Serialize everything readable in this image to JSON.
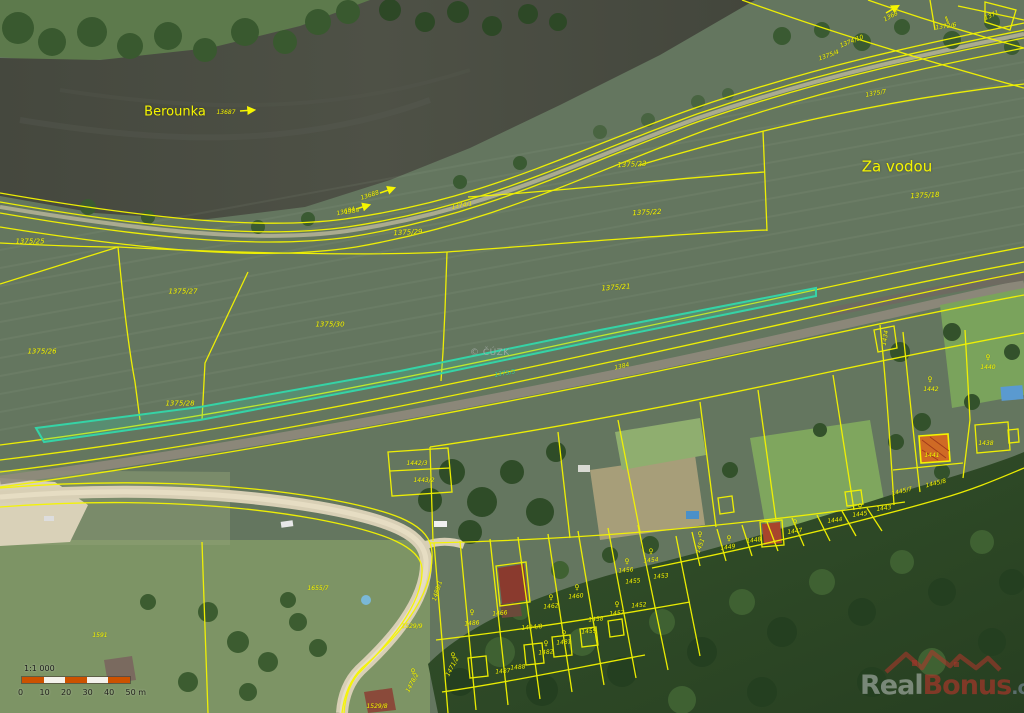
{
  "map": {
    "copyright": "© ČÚZK",
    "brand": {
      "real": "Real",
      "bonus": "Bonus",
      "cz": ".cz"
    },
    "scale_bar": {
      "ratio": "1:1 000",
      "ticks": [
        "0",
        "10",
        "20",
        "30",
        "40",
        "50 m"
      ]
    },
    "colors": {
      "parcel_line": "#f5f500",
      "parcel_label": "#f5f500",
      "highlight_parcel": "#35d3a6",
      "selected_building_fill": "#cf6a25",
      "scale_orange": "#cc5200",
      "river_water": "#46493f"
    },
    "highlighted_parcel": "1375/3",
    "selected_building": "1441",
    "labels": [
      {
        "t": "Berounka",
        "x": 175,
        "y": 112,
        "s": 13,
        "n": "river-name-label",
        "c": "place"
      },
      {
        "t": "Za vodou",
        "x": 897,
        "y": 167,
        "s": 15,
        "n": "place-name-label",
        "c": "place"
      },
      {
        "t": "13687",
        "x": 226,
        "y": 113,
        "s": 6,
        "n": "water-parcel-label"
      },
      {
        "t": "13688",
        "x": 370,
        "y": 196,
        "r": -18,
        "s": 6,
        "n": "water-parcel-label"
      },
      {
        "t": "13684",
        "x": 346,
        "y": 212,
        "r": -15,
        "s": 6,
        "n": "water-parcel-label"
      },
      {
        "t": "1368",
        "x": 891,
        "y": 17,
        "r": -28,
        "s": 6,
        "n": "water-parcel-label"
      },
      {
        "t": "1374/1",
        "x": 462,
        "y": 206,
        "r": -10,
        "s": 6
      },
      {
        "t": "1374/10",
        "x": 852,
        "y": 42,
        "r": -22,
        "s": 6
      },
      {
        "t": "1375/4",
        "x": 829,
        "y": 56,
        "r": -20,
        "s": 6
      },
      {
        "t": "1372/6",
        "x": 946,
        "y": 27,
        "r": -8,
        "s": 6
      },
      {
        "t": "1371",
        "x": 992,
        "y": 16,
        "r": -25,
        "s": 6
      },
      {
        "t": "1375/7",
        "x": 876,
        "y": 94,
        "r": -10,
        "s": 6
      },
      {
        "t": "1375/18",
        "x": 925,
        "y": 196,
        "r": -3
      },
      {
        "t": "1375/23",
        "x": 632,
        "y": 165,
        "r": -3
      },
      {
        "t": "1375/22",
        "x": 647,
        "y": 213,
        "r": -3
      },
      {
        "t": "1375/21",
        "x": 616,
        "y": 288,
        "r": -4
      },
      {
        "t": "1375/29",
        "x": 408,
        "y": 233,
        "r": -3
      },
      {
        "t": "1375/30",
        "x": 330,
        "y": 325
      },
      {
        "t": "1375/25",
        "x": 30,
        "y": 242
      },
      {
        "t": "1375/27",
        "x": 183,
        "y": 292
      },
      {
        "t": "1375/26",
        "x": 42,
        "y": 352
      },
      {
        "t": "1375/28",
        "x": 180,
        "y": 404
      },
      {
        "t": "1384",
        "x": 352,
        "y": 212,
        "r": -8,
        "s": 6
      },
      {
        "t": "1384",
        "x": 622,
        "y": 367,
        "r": -12,
        "s": 6
      },
      {
        "t": "1375/3",
        "x": 505,
        "y": 374,
        "r": -10,
        "s": 6,
        "c": "teal",
        "n": "highlighted-parcel-label"
      },
      {
        "t": "1442/3",
        "x": 417,
        "y": 464,
        "s": 6
      },
      {
        "t": "1443/2",
        "x": 424,
        "y": 481,
        "s": 6
      },
      {
        "t": "1434",
        "x": 886,
        "y": 338,
        "r": -80,
        "s": 6
      },
      {
        "t": "1440",
        "x": 988,
        "y": 368,
        "s": 6
      },
      {
        "t": "1442",
        "x": 931,
        "y": 390,
        "s": 6
      },
      {
        "t": "1441",
        "x": 932,
        "y": 456,
        "s": 6,
        "n": "selected-building-label"
      },
      {
        "t": "1438",
        "x": 986,
        "y": 444,
        "s": 6
      },
      {
        "t": "1445/8",
        "x": 936,
        "y": 484,
        "r": -14,
        "s": 6
      },
      {
        "t": "1445/7",
        "x": 902,
        "y": 492,
        "r": -14,
        "s": 6
      },
      {
        "t": "1443",
        "x": 884,
        "y": 509,
        "r": -8,
        "s": 6
      },
      {
        "t": "1445",
        "x": 860,
        "y": 515,
        "r": -8,
        "s": 6
      },
      {
        "t": "1444",
        "x": 835,
        "y": 521,
        "r": -8,
        "s": 6
      },
      {
        "t": "1447",
        "x": 795,
        "y": 532,
        "r": -8,
        "s": 6
      },
      {
        "t": "1448",
        "x": 754,
        "y": 541,
        "r": -8,
        "s": 6
      },
      {
        "t": "1449",
        "x": 728,
        "y": 548,
        "r": -8,
        "s": 6
      },
      {
        "t": "1451",
        "x": 701,
        "y": 546,
        "r": -70,
        "s": 6
      },
      {
        "t": "1456",
        "x": 626,
        "y": 571,
        "r": -5,
        "s": 6
      },
      {
        "t": "1455",
        "x": 633,
        "y": 582,
        "r": -5,
        "s": 6
      },
      {
        "t": "1454",
        "x": 651,
        "y": 561,
        "r": -5,
        "s": 6
      },
      {
        "t": "1453",
        "x": 661,
        "y": 577,
        "r": -5,
        "s": 6
      },
      {
        "t": "1452",
        "x": 639,
        "y": 606,
        "r": -5,
        "s": 6
      },
      {
        "t": "1457",
        "x": 617,
        "y": 614,
        "r": -5,
        "s": 6
      },
      {
        "t": "1458",
        "x": 596,
        "y": 620,
        "r": -5,
        "s": 6
      },
      {
        "t": "1459",
        "x": 589,
        "y": 632,
        "r": -5,
        "s": 6
      },
      {
        "t": "1460",
        "x": 576,
        "y": 597,
        "r": -5,
        "s": 6
      },
      {
        "t": "1462",
        "x": 551,
        "y": 607,
        "r": -5,
        "s": 6
      },
      {
        "t": "1466",
        "x": 500,
        "y": 614,
        "r": -5,
        "s": 6
      },
      {
        "t": "1494/8",
        "x": 532,
        "y": 628,
        "r": -5,
        "s": 6
      },
      {
        "t": "1486",
        "x": 472,
        "y": 624,
        "r": -5,
        "s": 6
      },
      {
        "t": "1489/1",
        "x": 438,
        "y": 591,
        "r": -72,
        "s": 6
      },
      {
        "t": "1482",
        "x": 546,
        "y": 653,
        "r": -5,
        "s": 6
      },
      {
        "t": "1481",
        "x": 564,
        "y": 643,
        "r": -5,
        "s": 6
      },
      {
        "t": "1488",
        "x": 518,
        "y": 668,
        "r": -5,
        "s": 6
      },
      {
        "t": "1487",
        "x": 503,
        "y": 672,
        "r": -5,
        "s": 6
      },
      {
        "t": "1529/9",
        "x": 412,
        "y": 627,
        "s": 6
      },
      {
        "t": "1529/8",
        "x": 377,
        "y": 707,
        "s": 6
      },
      {
        "t": "1478/2",
        "x": 413,
        "y": 683,
        "r": -62,
        "s": 6
      },
      {
        "t": "1471/2",
        "x": 453,
        "y": 667,
        "r": -62,
        "s": 6
      },
      {
        "t": "1655/7",
        "x": 318,
        "y": 589,
        "s": 6
      },
      {
        "t": "1591",
        "x": 100,
        "y": 636,
        "s": 6
      },
      {
        "t": "♀",
        "x": 472,
        "y": 613,
        "c": "sym",
        "n": "land-use-symbol"
      },
      {
        "t": "♀",
        "x": 551,
        "y": 598,
        "c": "sym",
        "n": "land-use-symbol"
      },
      {
        "t": "♀",
        "x": 577,
        "y": 588,
        "c": "sym",
        "n": "land-use-symbol"
      },
      {
        "t": "♀",
        "x": 617,
        "y": 605,
        "c": "sym",
        "n": "land-use-symbol"
      },
      {
        "t": "♀",
        "x": 627,
        "y": 562,
        "c": "sym",
        "n": "land-use-symbol"
      },
      {
        "t": "♀",
        "x": 651,
        "y": 552,
        "c": "sym",
        "n": "land-use-symbol"
      },
      {
        "t": "♀",
        "x": 700,
        "y": 535,
        "c": "sym",
        "n": "land-use-symbol"
      },
      {
        "t": "♀",
        "x": 729,
        "y": 539,
        "c": "sym",
        "n": "land-use-symbol"
      },
      {
        "t": "♀",
        "x": 795,
        "y": 523,
        "c": "sym",
        "n": "land-use-symbol"
      },
      {
        "t": "♀",
        "x": 860,
        "y": 507,
        "c": "sym",
        "n": "land-use-symbol"
      },
      {
        "t": "♀",
        "x": 988,
        "y": 358,
        "c": "sym",
        "n": "land-use-symbol"
      },
      {
        "t": "♀",
        "x": 930,
        "y": 380,
        "c": "sym",
        "n": "land-use-symbol"
      },
      {
        "t": "♀",
        "x": 546,
        "y": 644,
        "c": "sym",
        "n": "land-use-symbol"
      },
      {
        "t": "♀",
        "x": 564,
        "y": 634,
        "c": "sym",
        "n": "land-use-symbol"
      },
      {
        "t": "♀",
        "x": 413,
        "y": 672,
        "c": "sym",
        "n": "land-use-symbol"
      },
      {
        "t": "♀",
        "x": 453,
        "y": 656,
        "c": "sym",
        "n": "land-use-symbol"
      },
      {
        "t": "‖",
        "x": 947,
        "y": 20,
        "r": -20,
        "c": "sym",
        "n": "culvert-symbol"
      }
    ]
  }
}
